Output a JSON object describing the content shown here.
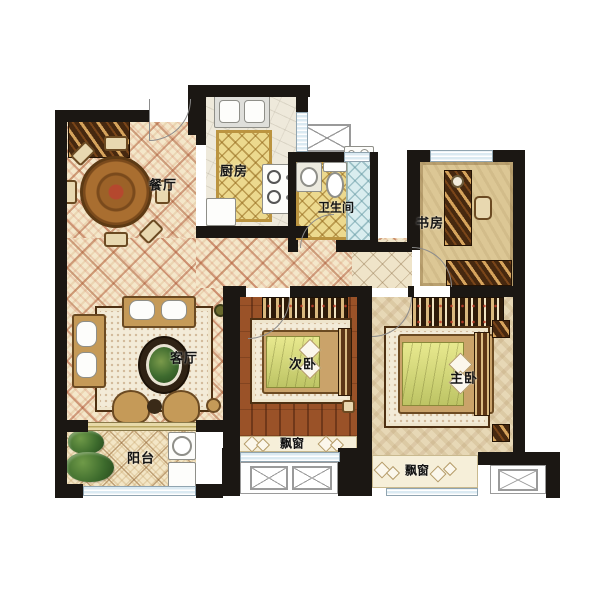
{
  "title": "三室两厅户型图 (3-bedroom apartment floor plan)",
  "rooms": {
    "dining": "餐厅",
    "kitchen": "厨房",
    "bathroom": "卫生间",
    "study": "书房",
    "living": "客厅",
    "second_bedroom": "次卧",
    "master_bedroom": "主卧",
    "balcony": "阳台",
    "bay_window_second": "飘窗",
    "bay_window_master": "飘窗"
  },
  "colors": {
    "wall": "#1b1713",
    "floor_cream": "#f4e7ca",
    "tile_yellow": "#ecd98e",
    "shower_blue": "#d9edef",
    "bedroom_wood": "#9a5228",
    "window_glass": "#dbeaf2",
    "label_text": "#141414"
  }
}
